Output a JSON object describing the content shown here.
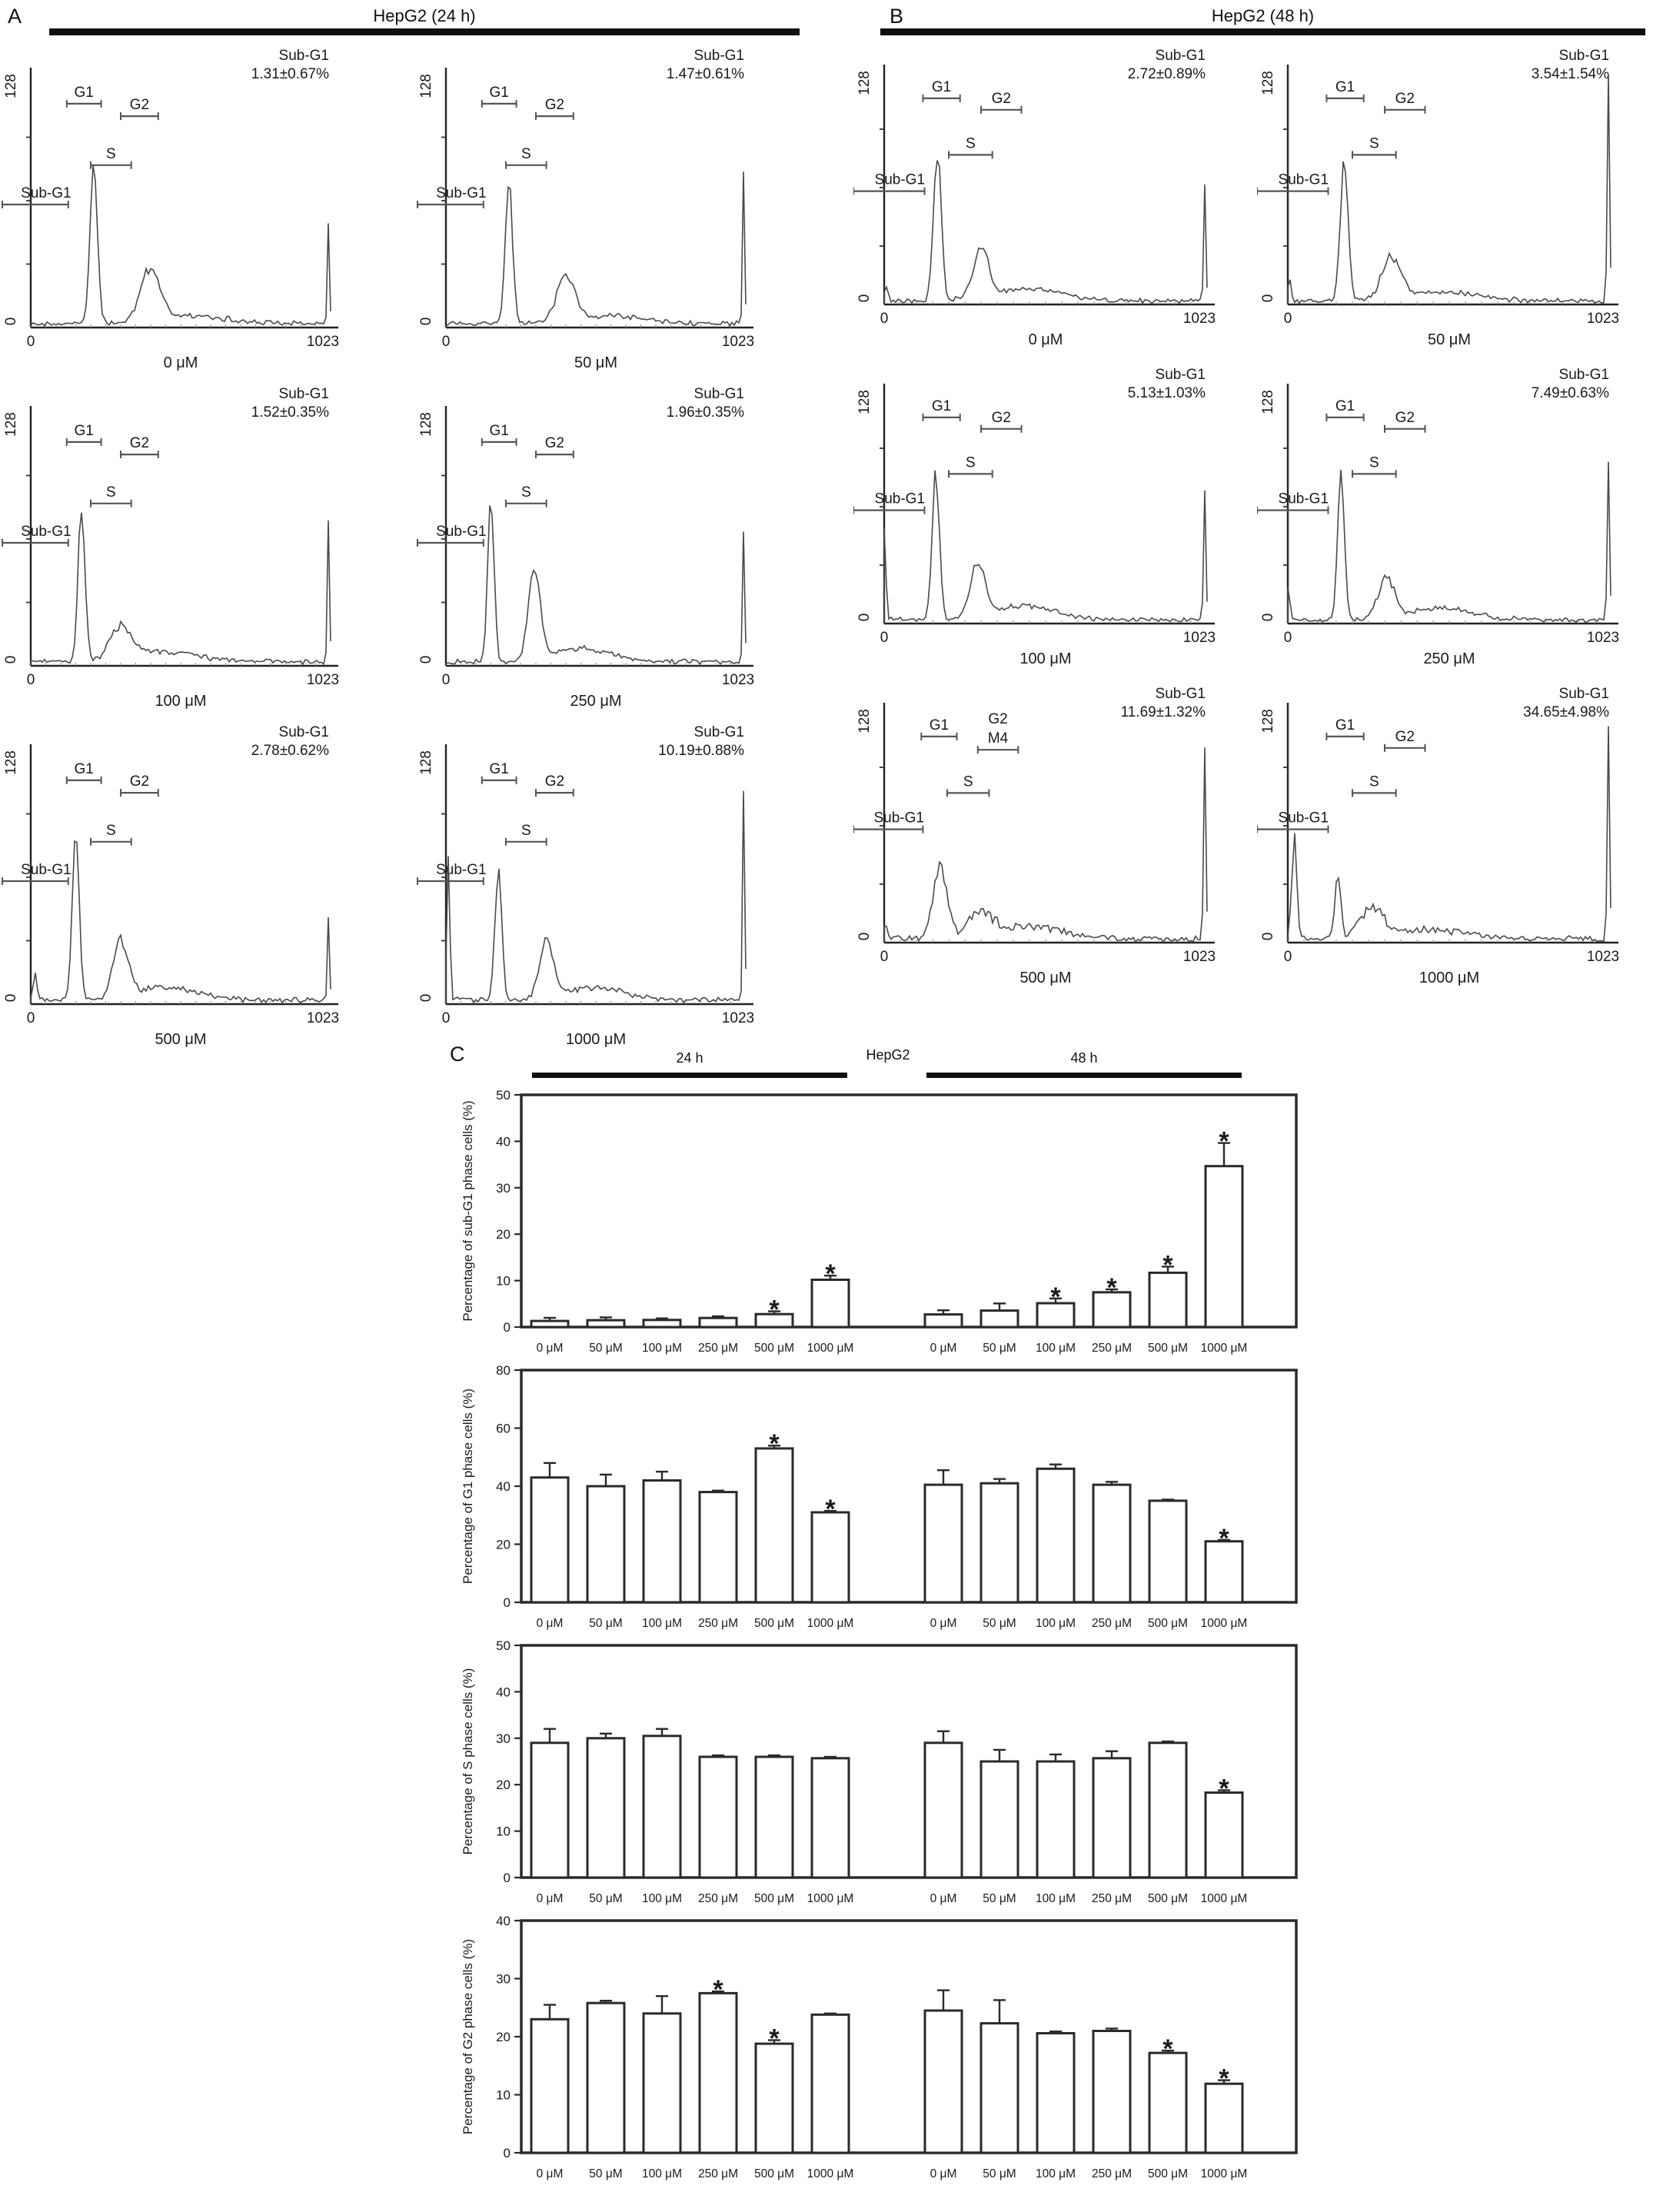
{
  "panel_c": {
    "letter": "C",
    "left": "24 h",
    "center": "HepG2",
    "right": "48 h"
  },
  "flow_axes": {
    "y_max": "128",
    "y_min": "0",
    "x_min": "0",
    "x_max": "1023"
  },
  "default_gates": [
    {
      "label": "G1",
      "x1": 0.12,
      "x2": 0.235,
      "y": 0.118
    },
    {
      "label": "G2",
      "x1": 0.3,
      "x2": 0.425,
      "y": 0.167
    },
    {
      "label": "S",
      "x1": 0.2,
      "x2": 0.335,
      "y": 0.36
    },
    {
      "label": "Sub-G1",
      "x1": -0.095,
      "x2": 0.125,
      "y": 0.515,
      "ldx": 14
    }
  ],
  "chart_data": [
    {
      "type": "histogram-panel",
      "letter": "A",
      "title": "HepG2 (24 h)",
      "annotation_title": "Sub-G1",
      "xlim": [
        0,
        1023
      ],
      "ylim": [
        0,
        128
      ],
      "plots": [
        {
          "concentration": "0 μM",
          "sub_g1": "1.31±0.67%",
          "peaks": [
            [
              0.21,
              0.64,
              0.017
            ],
            [
              0.4,
              0.21,
              0.045
            ],
            [
              0.55,
              0.03,
              0.15
            ]
          ],
          "spike": 0.38,
          "seed": 3
        },
        {
          "concentration": "50 μM",
          "sub_g1": "1.47±0.61%",
          "peaks": [
            [
              0.21,
              0.58,
              0.017
            ],
            [
              0.4,
              0.18,
              0.042
            ],
            [
              0.55,
              0.03,
              0.15
            ]
          ],
          "spike": 0.62,
          "seed": 7
        },
        {
          "concentration": "100 μM",
          "sub_g1": "1.52±0.35%",
          "peaks": [
            [
              0.17,
              0.62,
              0.016
            ],
            [
              0.3,
              0.13,
              0.05
            ],
            [
              0.45,
              0.04,
              0.15
            ]
          ],
          "spike": 0.56,
          "seed": 11
        },
        {
          "concentration": "250 μM",
          "sub_g1": "1.96±0.35%",
          "peaks": [
            [
              0.15,
              0.63,
              0.015
            ],
            [
              0.295,
              0.34,
              0.028
            ],
            [
              0.45,
              0.05,
              0.14
            ]
          ],
          "spike": 0.55,
          "seed": 13
        },
        {
          "concentration": "500 μM",
          "sub_g1": "2.78±0.62%",
          "peaks": [
            [
              0.015,
              0.1,
              0.008
            ],
            [
              0.15,
              0.66,
              0.016
            ],
            [
              0.3,
              0.22,
              0.035
            ],
            [
              0.45,
              0.05,
              0.15
            ]
          ],
          "spike": 0.34,
          "seed": 17
        },
        {
          "concentration": "1000 μM",
          "sub_g1": "10.19±0.88%",
          "peaks": [
            [
              0.008,
              0.55,
              0.007
            ],
            [
              0.175,
              0.52,
              0.016
            ],
            [
              0.335,
              0.23,
              0.032
            ],
            [
              0.5,
              0.05,
              0.14
            ]
          ],
          "spike": 0.8,
          "seed": 19
        }
      ]
    },
    {
      "type": "histogram-panel",
      "letter": "B",
      "title": "HepG2 (48 h)",
      "annotation_title": "Sub-G1",
      "xlim": [
        0,
        1023
      ],
      "ylim": [
        0,
        128
      ],
      "plots": [
        {
          "concentration": "0 μM",
          "sub_g1": "2.72±0.89%",
          "peaks": [
            [
              0.005,
              0.06,
              0.008
            ],
            [
              0.165,
              0.62,
              0.017
            ],
            [
              0.3,
              0.2,
              0.035
            ],
            [
              0.45,
              0.05,
              0.15
            ]
          ],
          "spike": 0.48,
          "seed": 23
        },
        {
          "concentration": "50 μM",
          "sub_g1": "3.54±1.54%",
          "peaks": [
            [
              0.005,
              0.08,
              0.008
            ],
            [
              0.175,
              0.6,
              0.017
            ],
            [
              0.32,
              0.18,
              0.04
            ],
            [
              0.48,
              0.04,
              0.15
            ]
          ],
          "spike": 0.97,
          "seed": 29
        },
        {
          "concentration": "100 μM",
          "sub_g1": "5.13±1.03%",
          "peaks": [
            [
              0.0,
              0.4,
              0.007
            ],
            [
              0.16,
              0.62,
              0.016
            ],
            [
              0.29,
              0.22,
              0.032
            ],
            [
              0.43,
              0.06,
              0.14
            ]
          ],
          "spike": 0.55,
          "seed": 31
        },
        {
          "concentration": "250 μM",
          "sub_g1": "7.49±0.63%",
          "peaks": [
            [
              0.0,
              0.13,
              0.008
            ],
            [
              0.165,
              0.6,
              0.015
            ],
            [
              0.305,
              0.17,
              0.035
            ],
            [
              0.47,
              0.05,
              0.14
            ]
          ],
          "spike": 0.7,
          "seed": 37
        },
        {
          "concentration": "500 μM",
          "sub_g1": "11.69±1.32%",
          "noise": 1.8,
          "peaks": [
            [
              0.0,
              0.07,
              0.01
            ],
            [
              0.175,
              0.29,
              0.032
            ],
            [
              0.3,
              0.1,
              0.05
            ],
            [
              0.45,
              0.05,
              0.16
            ]
          ],
          "spike": 0.74,
          "seed": 41,
          "gates": [
            {
              "label": "G1",
              "x1": 0.115,
              "x2": 0.225,
              "y": 0.118
            },
            {
              "labels": [
                "G2",
                "M4"
              ],
              "x1": 0.29,
              "x2": 0.415,
              "y": 0.175
            },
            {
              "label": "S",
              "x1": 0.195,
              "x2": 0.325,
              "y": 0.36
            },
            {
              "label": "Sub-G1",
              "x1": -0.095,
              "x2": 0.12,
              "y": 0.515,
              "ldx": 14
            }
          ]
        },
        {
          "concentration": "1000 μM",
          "sub_g1": "34.65±4.98%",
          "noise": 1.5,
          "peaks": [
            [
              0.02,
              0.42,
              0.011
            ],
            [
              0.155,
              0.28,
              0.013
            ],
            [
              0.26,
              0.13,
              0.05
            ],
            [
              0.45,
              0.04,
              0.15
            ]
          ],
          "spike": 0.9,
          "seed": 43
        }
      ]
    },
    {
      "type": "bar",
      "ylabel": "Percentage of sub-G1 phase cells (%)",
      "ylim": [
        0,
        50
      ],
      "yticks": [
        0,
        10,
        20,
        30,
        40,
        50
      ],
      "categories": [
        "0 μM",
        "50 μM",
        "100 μM",
        "250 μM",
        "500 μM",
        "1000 μM"
      ],
      "series": [
        {
          "name": "24 h",
          "values": [
            1.31,
            1.47,
            1.52,
            1.96,
            2.78,
            10.19
          ],
          "errors": [
            0.67,
            0.61,
            0.35,
            0.35,
            0.62,
            0.88
          ],
          "sig": [
            false,
            false,
            false,
            false,
            true,
            true
          ]
        },
        {
          "name": "48 h",
          "values": [
            2.72,
            3.54,
            5.13,
            7.49,
            11.69,
            34.65
          ],
          "errors": [
            0.89,
            1.54,
            1.03,
            0.63,
            1.32,
            4.98
          ],
          "sig": [
            false,
            false,
            true,
            true,
            true,
            true
          ]
        }
      ]
    },
    {
      "type": "bar",
      "ylabel": "Percentage of G1 phase cells (%)",
      "ylim": [
        0,
        80
      ],
      "yticks": [
        0,
        20,
        40,
        60,
        80
      ],
      "categories": [
        "0 μM",
        "50 μM",
        "100 μM",
        "250 μM",
        "500 μM",
        "1000 μM"
      ],
      "series": [
        {
          "name": "24 h",
          "values": [
            43,
            40,
            42,
            38,
            53,
            31
          ],
          "errors": [
            5,
            4,
            3,
            0.5,
            1,
            0.5
          ],
          "sig": [
            false,
            false,
            false,
            false,
            true,
            true
          ]
        },
        {
          "name": "48 h",
          "values": [
            40.5,
            41,
            46,
            40.5,
            35,
            21
          ],
          "errors": [
            5,
            1.5,
            1.5,
            1,
            0.4,
            0.5
          ],
          "sig": [
            false,
            false,
            false,
            false,
            false,
            true
          ]
        }
      ]
    },
    {
      "type": "bar",
      "ylabel": "Percentage of S phase cells (%)",
      "ylim": [
        0,
        50
      ],
      "yticks": [
        0,
        10,
        20,
        30,
        40,
        50
      ],
      "categories": [
        "0 μM",
        "50 μM",
        "100 μM",
        "250 μM",
        "500 μM",
        "1000 μM"
      ],
      "series": [
        {
          "name": "24 h",
          "values": [
            29,
            30,
            30.5,
            26,
            26,
            25.7
          ],
          "errors": [
            3,
            1,
            1.5,
            0.3,
            0.3,
            0.3
          ],
          "sig": [
            false,
            false,
            false,
            false,
            false,
            false
          ]
        },
        {
          "name": "48 h",
          "values": [
            29,
            25,
            25,
            25.7,
            29,
            18.3
          ],
          "errors": [
            2.5,
            2.5,
            1.5,
            1.5,
            0.3,
            0.5
          ],
          "sig": [
            false,
            false,
            false,
            false,
            false,
            true
          ]
        }
      ]
    },
    {
      "type": "bar",
      "ylabel": "Percentage of G2 phase cells (%)",
      "ylim": [
        0,
        40
      ],
      "yticks": [
        0,
        10,
        20,
        30,
        40
      ],
      "categories": [
        "0 μM",
        "50 μM",
        "100 μM",
        "250 μM",
        "500 μM",
        "1000 μM"
      ],
      "series": [
        {
          "name": "24 h",
          "values": [
            23,
            25.8,
            24,
            27.5,
            18.8,
            23.8
          ],
          "errors": [
            2.5,
            0.4,
            3,
            0.3,
            0.6,
            0.2
          ],
          "sig": [
            false,
            false,
            false,
            true,
            true,
            false
          ]
        },
        {
          "name": "48 h",
          "values": [
            24.5,
            22.3,
            20.6,
            21,
            17.2,
            11.9
          ],
          "errors": [
            3.5,
            4,
            0.3,
            0.4,
            0.4,
            0.6
          ],
          "sig": [
            false,
            false,
            false,
            false,
            true,
            true
          ]
        }
      ]
    }
  ]
}
